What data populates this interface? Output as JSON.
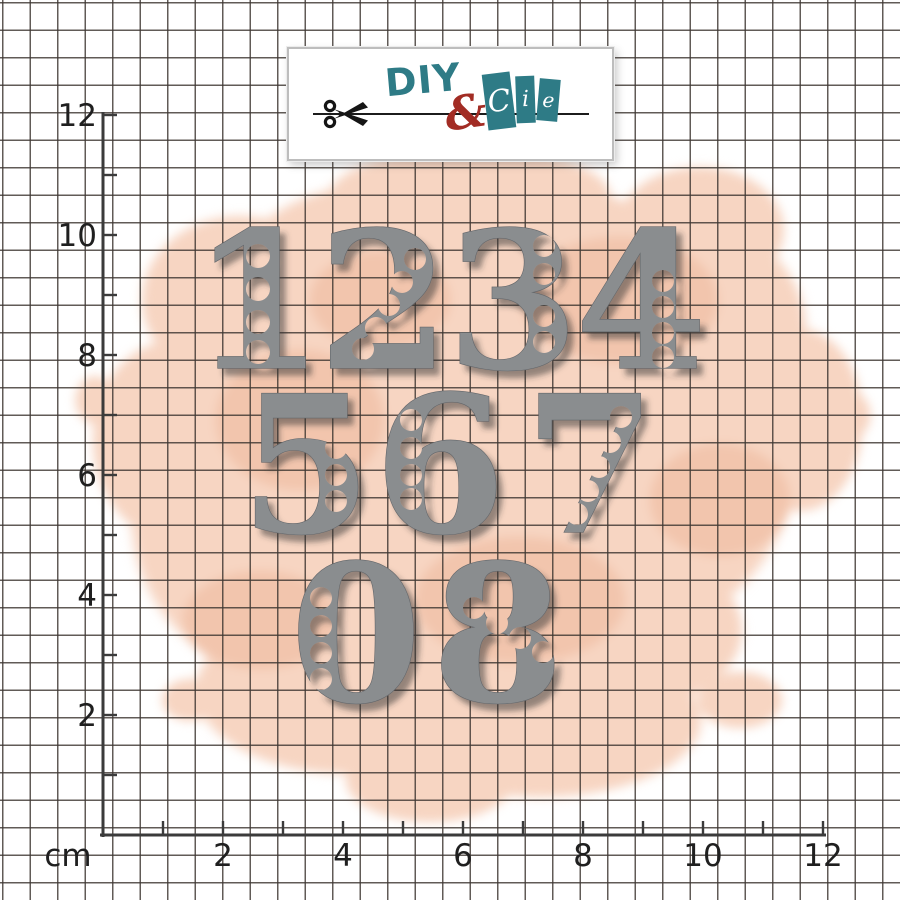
{
  "logo": {
    "diy": "DIY",
    "ampersand": "&",
    "cie_letters": [
      "C",
      "i",
      "e"
    ],
    "colors": {
      "teal": "#2e7b86",
      "red": "#a22c24",
      "scissors": "#151515"
    }
  },
  "ruler": {
    "unit_label": "cm",
    "px_per_cm": 60,
    "origin_x": 103,
    "origin_y": 835,
    "length_cm": 12,
    "tick_len_px": 14,
    "numbered_ticks": [
      2,
      4,
      6,
      8,
      10,
      12
    ],
    "axis_color": "#3b3b3b",
    "label_color": "#1f1f1f",
    "label_font_px": 31
  },
  "grid": {
    "spacing_px": 27.5,
    "line_color": "rgba(62,55,50,0.82)",
    "line_px": 1.7
  },
  "watercolor": {
    "base_color": "#f7d5c2",
    "accent_color": "#f2c5ad"
  },
  "dies": {
    "fill": "#8a8d8f",
    "outline": "#63666a",
    "shadow_color": "#2f2f2f",
    "font_px": 190,
    "items": [
      {
        "digit": "1",
        "cx": 258,
        "baseline": 368,
        "holes": [
          [
            258,
            256,
            12
          ],
          [
            258,
            289,
            12
          ],
          [
            258,
            322,
            12
          ],
          [
            258,
            352,
            12
          ]
        ]
      },
      {
        "digit": "2",
        "cx": 384,
        "baseline": 368,
        "holes": [
          [
            415,
            259,
            11
          ],
          [
            402,
            282,
            11
          ],
          [
            389,
            305,
            11
          ],
          [
            376,
            328,
            11
          ],
          [
            363,
            349,
            11
          ]
        ]
      },
      {
        "digit": "3",
        "cx": 513,
        "baseline": 368,
        "holes": [
          [
            544,
            246,
            11
          ],
          [
            544,
            274,
            11
          ],
          [
            544,
            316,
            11
          ],
          [
            544,
            342,
            11
          ]
        ]
      },
      {
        "digit": "4",
        "cx": 641,
        "baseline": 368,
        "holes": [
          [
            663,
            281,
            11
          ],
          [
            663,
            307,
            11
          ],
          [
            663,
            333,
            11
          ],
          [
            663,
            357,
            11
          ]
        ]
      },
      {
        "digit": "5",
        "cx": 306,
        "baseline": 532,
        "holes": [
          [
            336,
            448,
            11
          ],
          [
            336,
            475,
            11
          ],
          [
            336,
            501,
            11
          ]
        ]
      },
      {
        "digit": "6",
        "cx": 440,
        "baseline": 532,
        "holes": [
          [
            411,
            420,
            11
          ],
          [
            411,
            448,
            11
          ],
          [
            411,
            475,
            11
          ],
          [
            411,
            499,
            11
          ]
        ]
      },
      {
        "digit": "7",
        "cx": 590,
        "baseline": 532,
        "holes": [
          [
            621,
            417,
            11
          ],
          [
            610,
            442,
            11
          ],
          [
            599,
            467,
            11
          ],
          [
            588,
            491,
            11
          ],
          [
            577,
            514,
            11
          ]
        ]
      },
      {
        "digit": "0",
        "cx": 356,
        "baseline": 701,
        "holes": [
          [
            321,
            598,
            11
          ],
          [
            321,
            626,
            11
          ],
          [
            321,
            653,
            11
          ],
          [
            321,
            679,
            11
          ]
        ]
      },
      {
        "digit": "8",
        "cx": 498,
        "baseline": 701,
        "holes": [
          [
            474,
            608,
            11
          ],
          [
            497,
            623,
            11
          ],
          [
            520,
            638,
            11
          ],
          [
            543,
            652,
            11
          ]
        ]
      }
    ]
  }
}
